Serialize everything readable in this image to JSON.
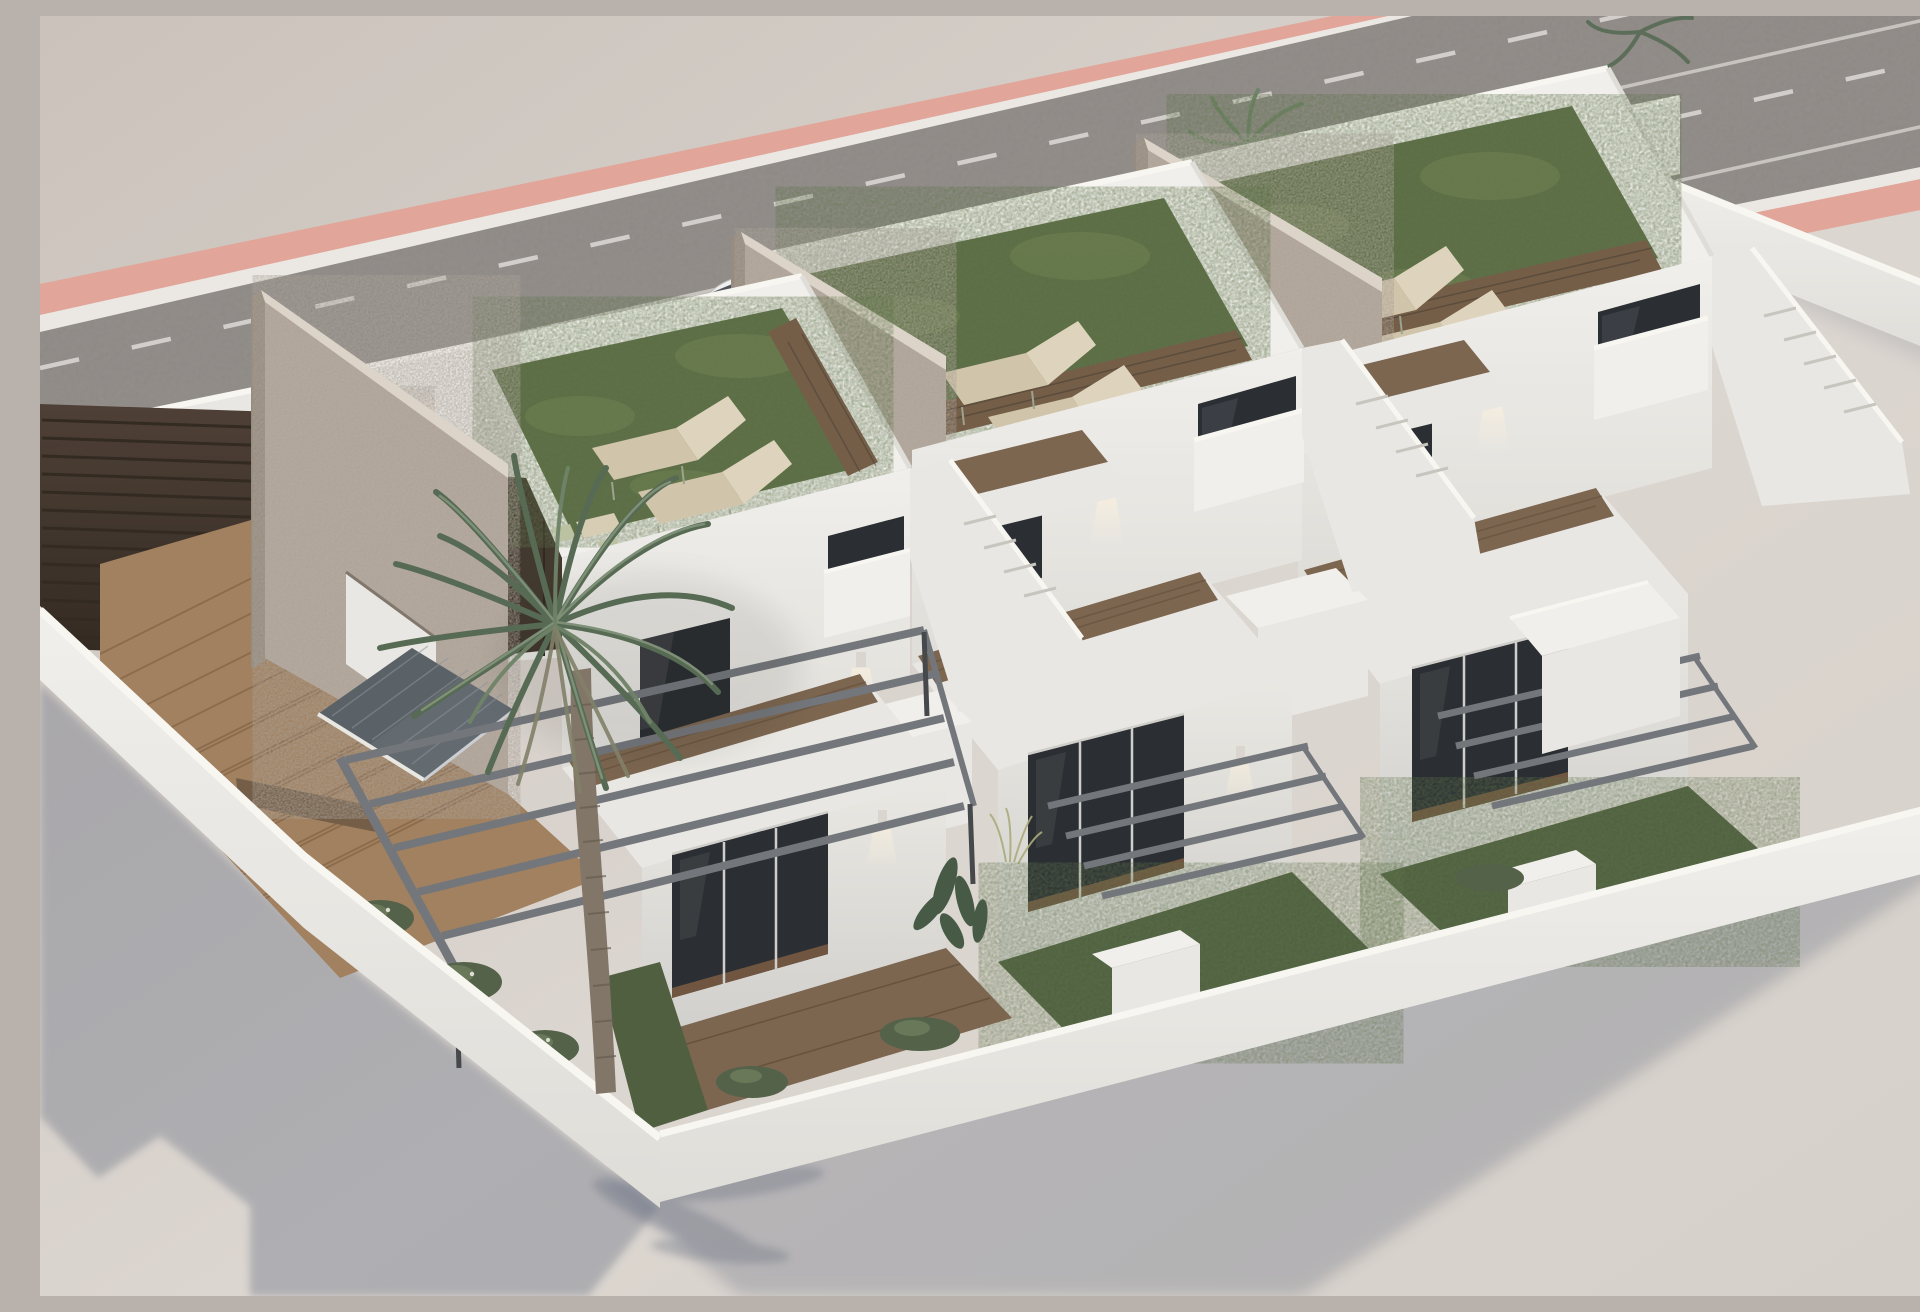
{
  "scene": {
    "title": "Aerial 3D render of three new-build white villas with roof terraces",
    "description": "Architectural visualization, high-angle aerial view: a row of three modern two-storey white townhouses with artificial-grass roof terraces and sun loungers, stone privacy walls between roofs, dark glazed openings, front patios with pergolas, a grey tiled porch canopy, a small turquoise pool on a timber deck, a slatted entrance gate, a tall palm tree, long cast shadows, and an asphalt road with white lane markings and a salmon sidewalk strip running behind the plot.",
    "view": "high-angle three-quarter aerial view",
    "houses_count": 3
  },
  "inventory": {
    "roof_terraces": 3,
    "sun_loungers_per_roof": 2,
    "stone_privacy_walls": 3,
    "palm_trees": 2,
    "pools": 1,
    "pergolas": 3,
    "tiled_canopies": 1,
    "entrance_gates": 2,
    "parked_cars": 1,
    "wall_lamps": 6,
    "road_lane_lines": [
      "dashed",
      "solid",
      "dashed",
      "solid",
      "dashed"
    ]
  },
  "palette": {
    "bg1": "#c9c0ba",
    "bg2": "#dbd5d0",
    "bg3": "#d5cfc9",
    "road": "#8b8683",
    "roadDark": "#7b7773",
    "pink": "#e0a396",
    "curb": "#ebe8e4",
    "laneWhite": "#d8d5d2",
    "wallLit": "#f1efec",
    "wall": "#e9e7e3",
    "wallMid": "#dedcd8",
    "wallShade": "#cfcecb",
    "coping": "#f8f6f2",
    "stone": "#b3a79b",
    "stoneDark": "#93887c",
    "stoneCoping": "#dbd2c8",
    "turf": "#57683f",
    "turfDark": "#49593a",
    "turfLight": "#798c55",
    "wood": "#9e7c5a",
    "woodDark": "#77604a",
    "walkway": "#6f5842",
    "glass": "#23272c",
    "glassHi": "#434a51",
    "frame": "#cfcdc9",
    "pool1": "#4cc0b9",
    "pool2": "#2d9a95",
    "lounger": "#cfc2a8",
    "loungerHi": "#ddd2bb",
    "pergola": "#6e7277",
    "canopy": "#5d646c",
    "canopyDark": "#4c535b",
    "gate": "#483930",
    "gateDark": "#2b221b",
    "green": "#4e5c44",
    "greenLight": "#6d7d5c",
    "shadow": "#5a6478",
    "car": "#eef0f0",
    "carGlass": "#363c42",
    "trunk": "#7d7164",
    "trunkDark": "#5e5449",
    "frond1": "#51654f",
    "frond2": "#697e63",
    "frond3": "#7e9077",
    "frondDry": "#7d7c64",
    "sconce": "#d9d5cf",
    "lightWarm": "#fff3dc"
  }
}
